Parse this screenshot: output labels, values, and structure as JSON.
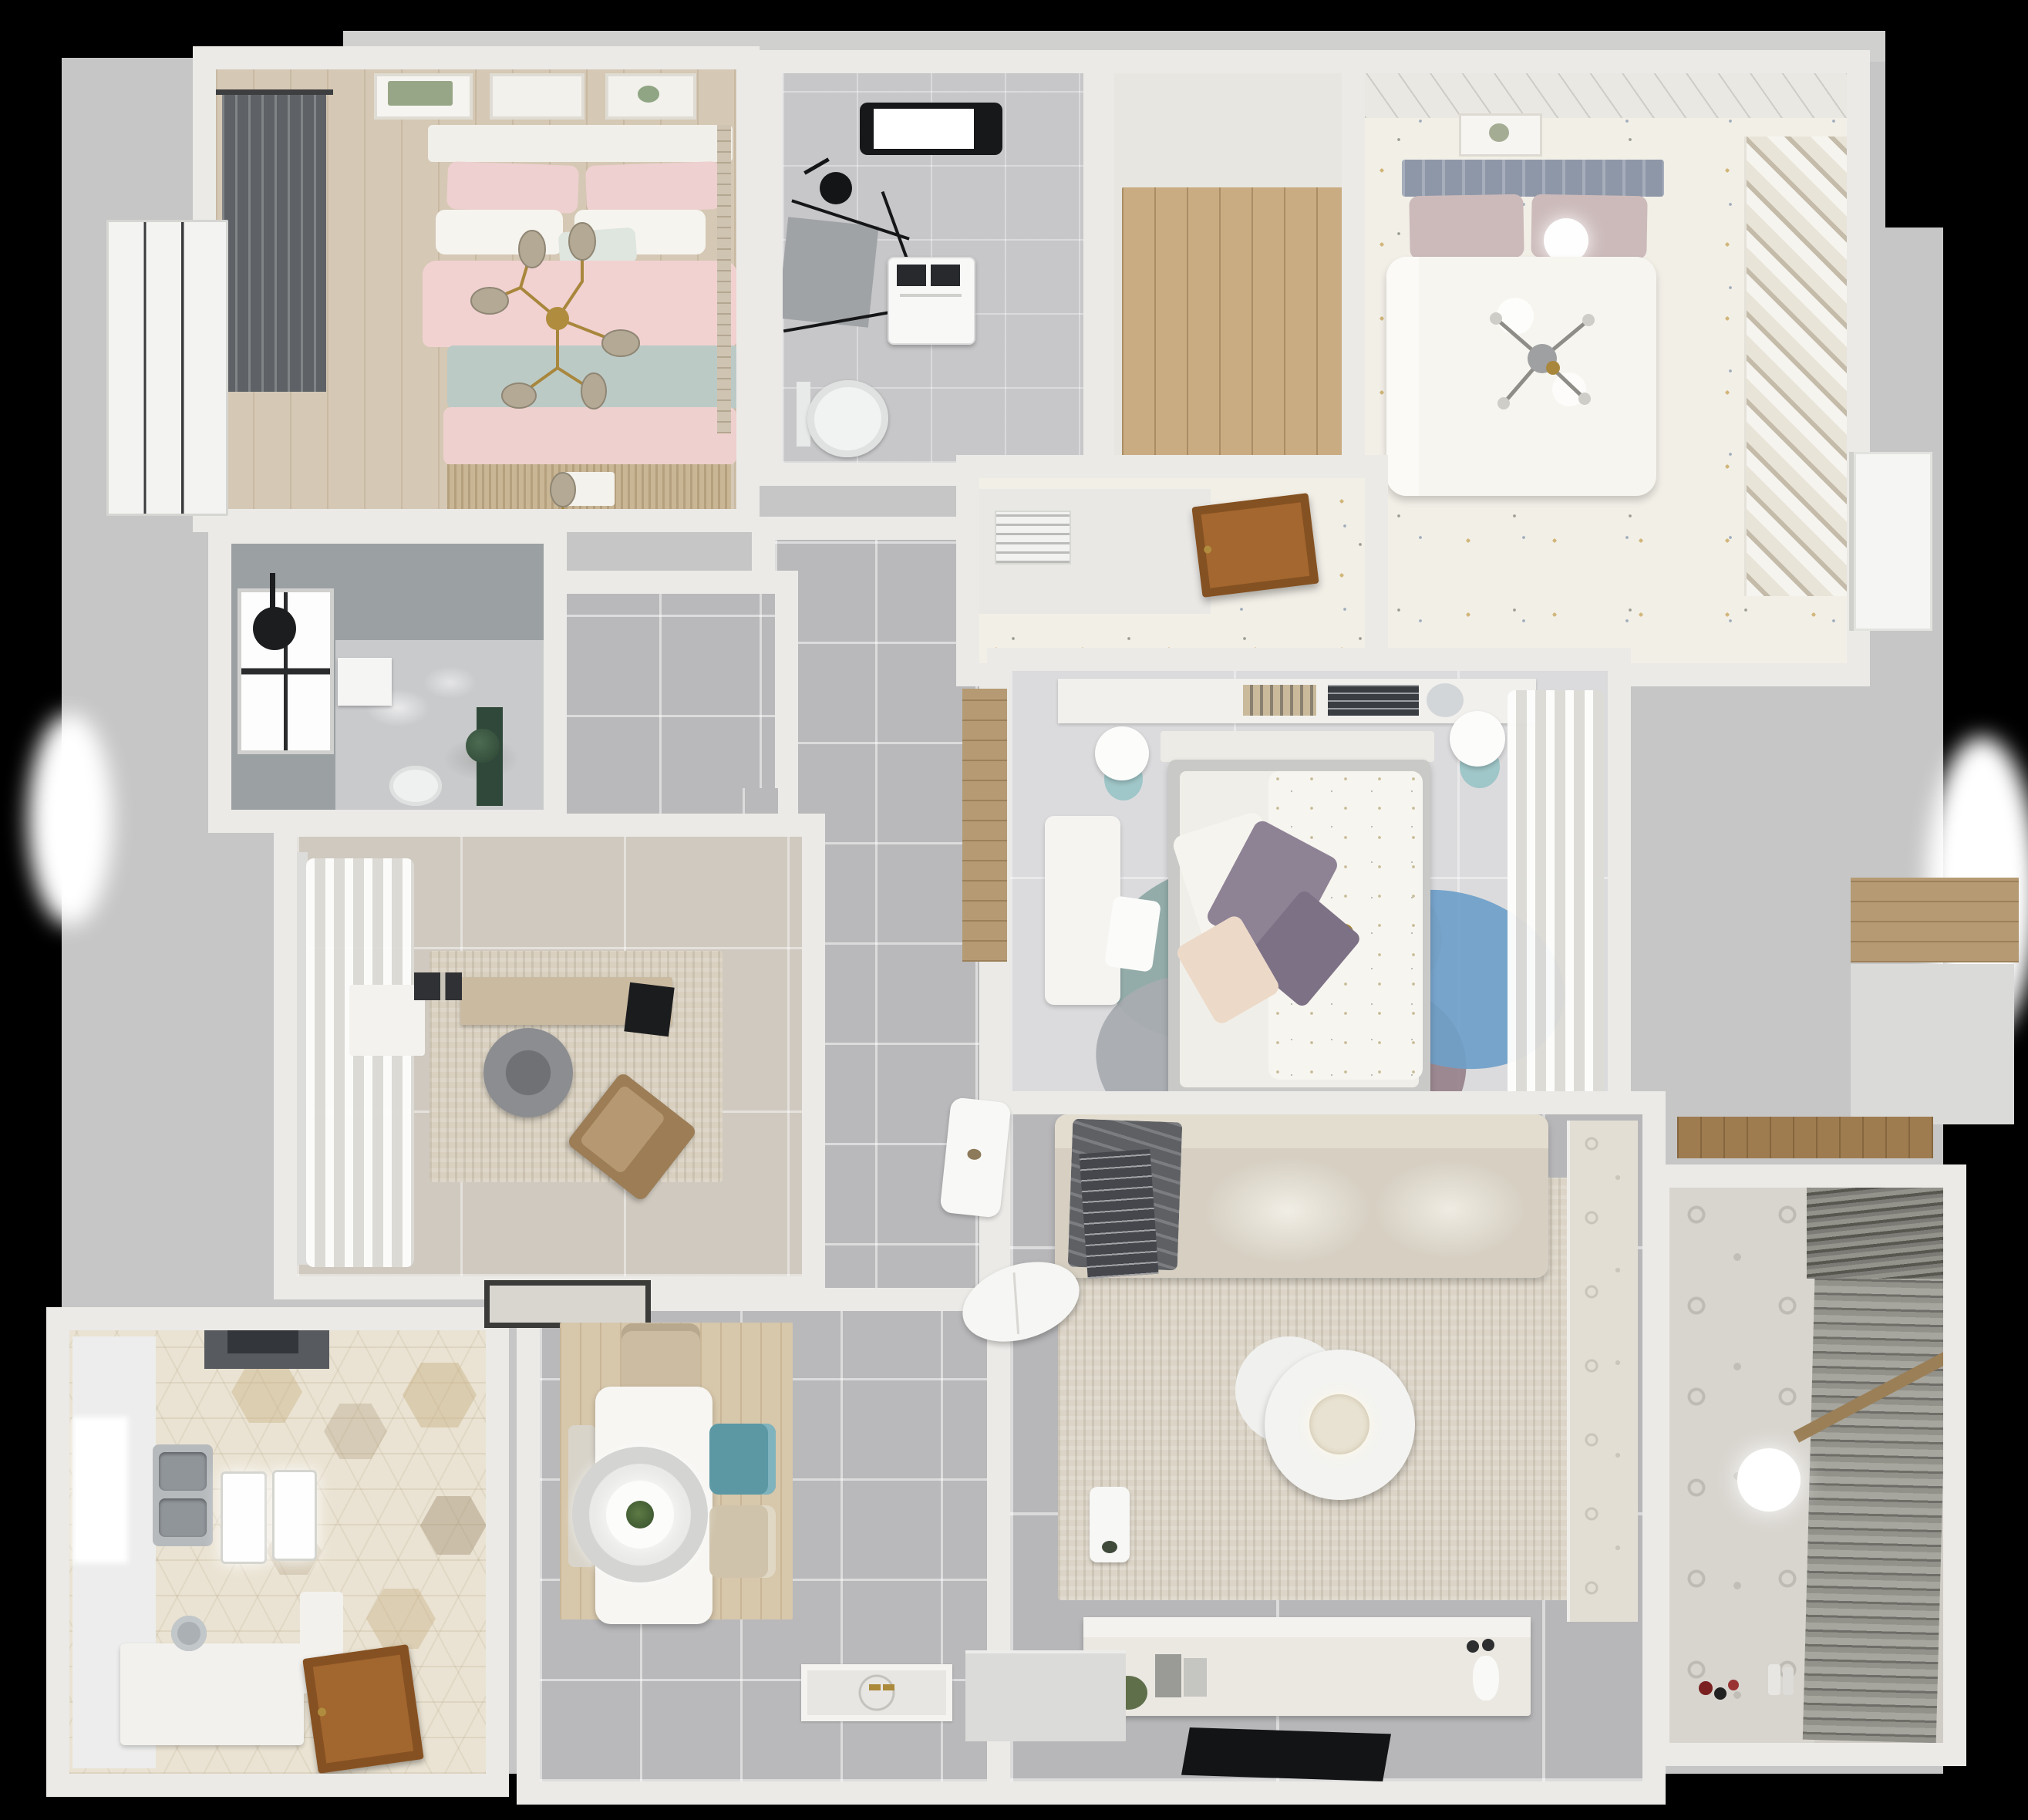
{
  "scene": {
    "title": "Top-down 3D render of an apartment floor plan",
    "background": "#000000"
  },
  "palette": {
    "wall": "#ebeae7",
    "slab": "#c6c6c6",
    "corridor_tile": "#b9b9bb",
    "living_tile": "#b7b7b9",
    "master_wood": "#d5c8b4",
    "kids_floor": "#f2efe7",
    "kitchen_hex": "#eae3d3",
    "accent_pink": "#eed0ce",
    "accent_teal_chair": "#5b98a4",
    "accent_blue_rug": "#6f9fc9",
    "accent_gold": "#a8873d",
    "dark_bath": "#9ba0a3",
    "wood_door": "#a2662f"
  },
  "rooms": [
    {
      "id": "master-bedroom",
      "name": "Master bedroom",
      "floor": "wood planks",
      "furniture": [
        "double bed with pink and sage bedding",
        "gold branch chandelier",
        "three wall-art frames",
        "dark window with curtains",
        "fringed bed-end runner"
      ]
    },
    {
      "id": "ensuite-bathroom",
      "name": "Dark en-suite bathroom",
      "floor": "dark tile with marble",
      "furniture": [
        "paned window",
        "black ceiling shower head",
        "wall-hung toilet",
        "green plant unit"
      ]
    },
    {
      "id": "study",
      "name": "Study",
      "floor": "beige tile",
      "furniture": [
        "wood desk",
        "black monitor",
        "round gray chair",
        "brown lounge chair",
        "textured rug",
        "white curtains",
        "black door mat"
      ]
    },
    {
      "id": "kitchen",
      "name": "Kitchen",
      "floor": "hexagon tile",
      "furniture": [
        "double stainless sink",
        "dark range hood",
        "island counter with faucet",
        "two pendant lights",
        "open wooden door",
        "bright window"
      ]
    },
    {
      "id": "main-bathroom",
      "name": "Main bathroom",
      "floor": "gray tile",
      "furniture": [
        "black skylight",
        "corner glass shower",
        "washing machine",
        "toilet"
      ]
    },
    {
      "id": "entry-closet",
      "name": "Walk-in closet",
      "floor": "wood planks",
      "furniture": []
    },
    {
      "id": "kids-bedroom",
      "name": "Kids bedroom",
      "floor": "speckled terrazzo",
      "furniture": [
        "bed with blue-gray headboard",
        "mauve pillows",
        "white sphere lamp",
        "cross chandelier",
        "diagonal slatted wardrobe",
        "open wooden door",
        "air vent grille",
        "picture frame"
      ]
    },
    {
      "id": "middle-bedroom",
      "name": "Middle bedroom",
      "floor": "pale tile",
      "furniture": [
        "bed with floral duvet",
        "purple pillows",
        "petal rug in blue, mauve and teal",
        "white desk and chair",
        "two round stools",
        "book shelf",
        "white curtains",
        "wood niche"
      ]
    },
    {
      "id": "living-room",
      "name": "Living room",
      "floor": "gray tile",
      "furniture": [
        "beige sectional sofa",
        "gray throw and striped blanket",
        "large beige rug",
        "round layered coffee table",
        "tv console with decor",
        "flat tv panel",
        "white side table",
        "patterned tile strip"
      ]
    },
    {
      "id": "dining-area",
      "name": "Dining area",
      "floor": "gray tile with wood mat",
      "furniture": [
        "white dining table",
        "ring pendant lamp with plant",
        "teal chair",
        "two beige chairs",
        "side chair"
      ]
    },
    {
      "id": "hallway",
      "name": "Hallway",
      "floor": "gray tile",
      "furniture": []
    },
    {
      "id": "balcony",
      "name": "Balcony laundry",
      "floor": "patterned tile",
      "furniture": [
        "venetian blinds",
        "white ball pendant",
        "scattered toys",
        "wood shelf"
      ]
    },
    {
      "id": "entrance",
      "name": "Entrance",
      "floor": "gray tile",
      "furniture": [
        "patterned entry mat",
        "gold door handles",
        "door sill"
      ]
    }
  ]
}
